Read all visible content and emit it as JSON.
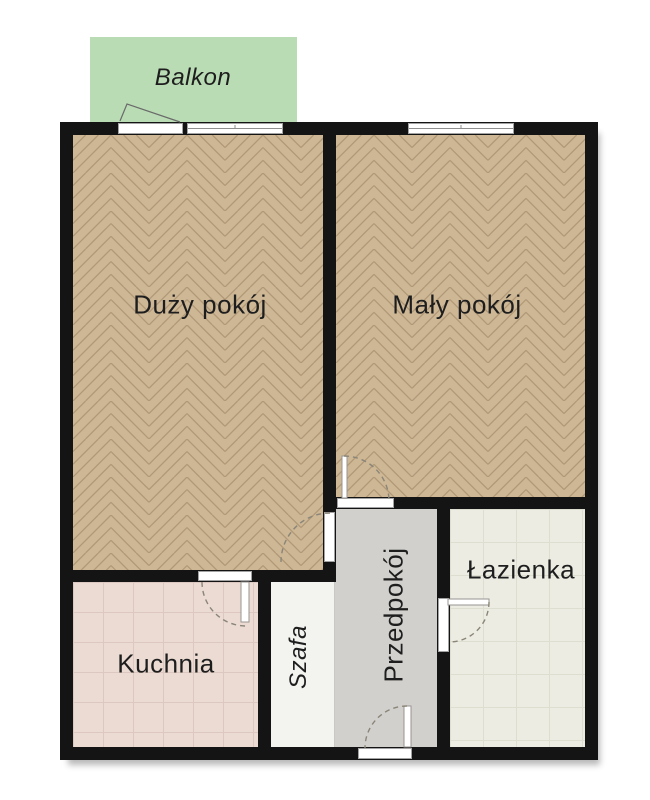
{
  "plan_title": "apartment-floor-plan",
  "rooms": {
    "balkon": {
      "label": "Balkon"
    },
    "duzy_pokoj": {
      "label": "Duży pokój"
    },
    "maly_pokoj": {
      "label": "Mały pokój"
    },
    "kuchnia": {
      "label": "Kuchnia"
    },
    "szafa": {
      "label": "Szafa"
    },
    "przedpokoj": {
      "label": "Przedpokój"
    },
    "lazienka": {
      "label": "Łazienka"
    }
  },
  "colors": {
    "wall": "#141414",
    "balcony": "#b9dcb4",
    "wood_base": "#cdb795",
    "wood_stroke": "#aa9170",
    "kitchen_floor": "#ebdbd3",
    "bathroom_floor": "#ecece3",
    "hallway_floor": "#d1d0cc",
    "wardrobe_floor": "#f3f3f0",
    "door_arc": "#8a8578",
    "door_leaf_stroke": "#999590",
    "window_line": "#8f8f8f",
    "label_text": "#1e1e1e"
  }
}
